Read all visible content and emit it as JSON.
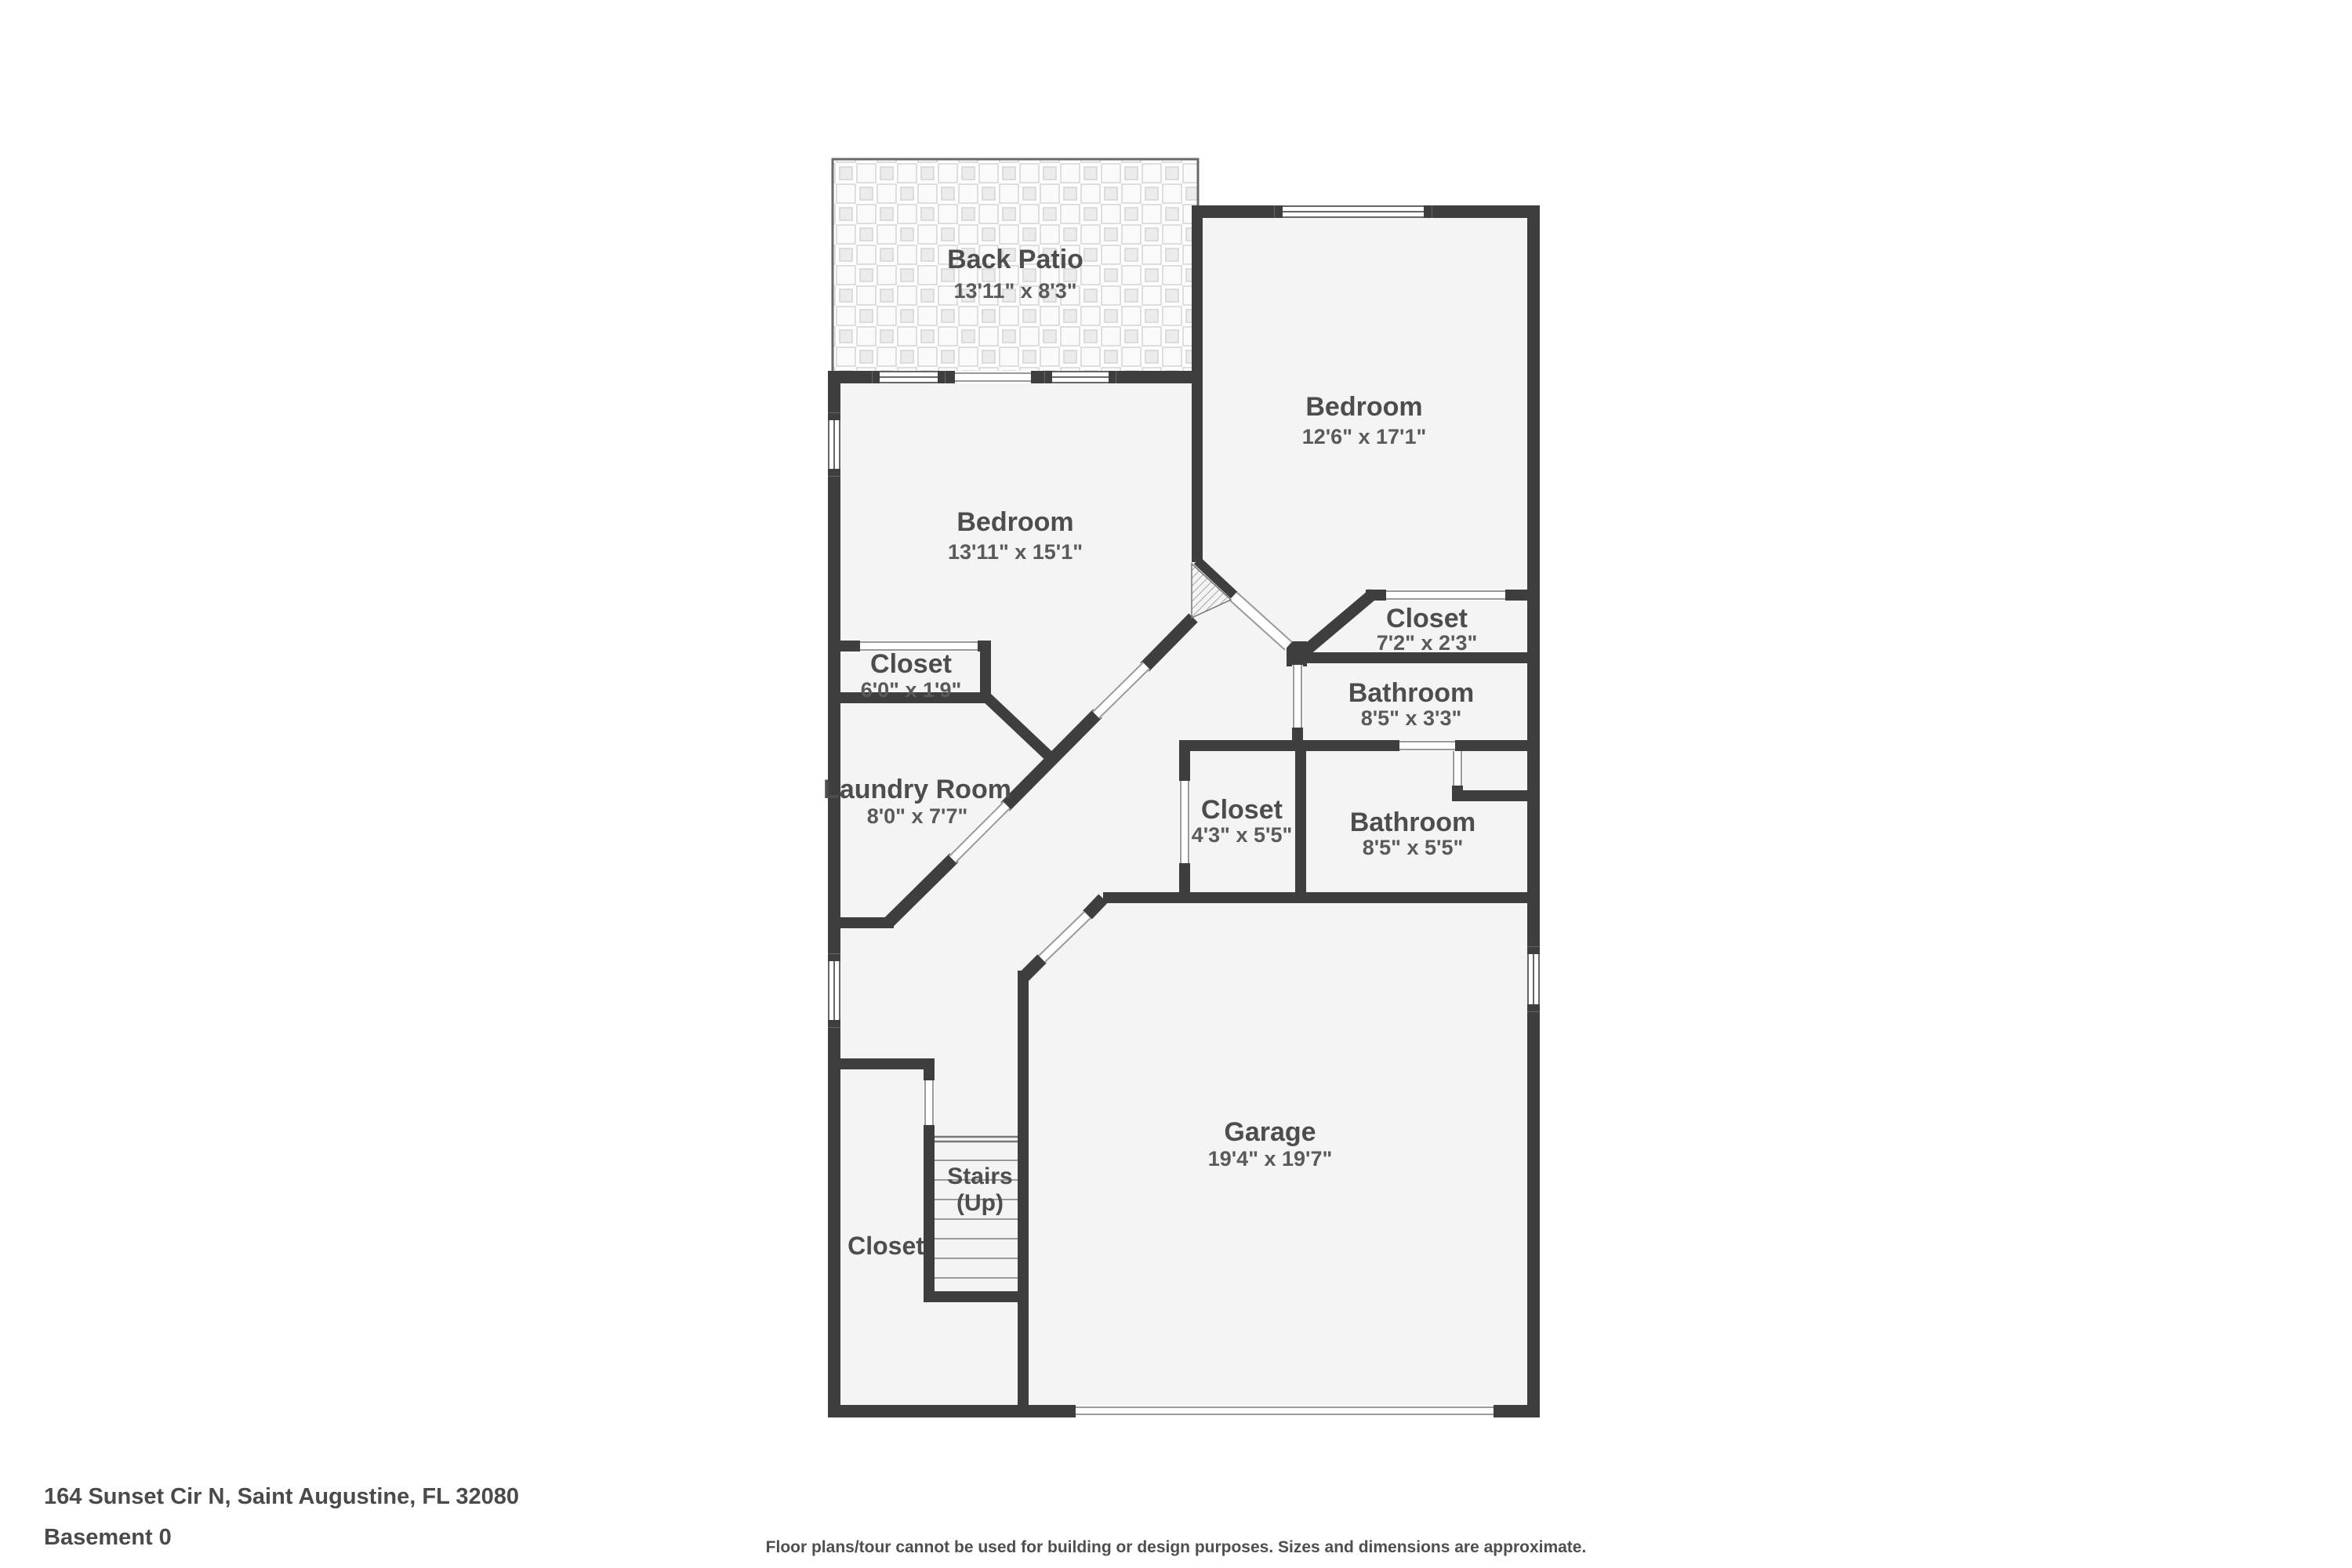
{
  "rooms": {
    "back_patio": {
      "name": "Back Patio",
      "dims": "13'11\" x 8'3\""
    },
    "bedroom_right": {
      "name": "Bedroom",
      "dims": "12'6\" x 17'1\""
    },
    "bedroom_left": {
      "name": "Bedroom",
      "dims": "13'11\" x 15'1\""
    },
    "closet_bedroom_left": {
      "name": "Closet",
      "dims": "6'0\" x 1'9\""
    },
    "closet_bedroom_right": {
      "name": "Closet",
      "dims": "7'2\" x 2'3\""
    },
    "bathroom_small": {
      "name": "Bathroom",
      "dims": "8'5\" x 3'3\""
    },
    "laundry": {
      "name": "Laundry Room",
      "dims": "8'0\" x 7'7\""
    },
    "closet_hall": {
      "name": "Closet",
      "dims": "4'3\" x 5'5\""
    },
    "bathroom_large": {
      "name": "Bathroom",
      "dims": "8'5\" x 5'5\""
    },
    "garage": {
      "name": "Garage",
      "dims": "19'4\" x 19'7\""
    },
    "stairs": {
      "name": "Stairs",
      "note": "(Up)"
    },
    "closet_lower": {
      "name": "Closet"
    }
  },
  "footer": {
    "address": "164 Sunset Cir N, Saint Augustine, FL 32080",
    "floor_label": "Basement 0",
    "disclaimer": "Floor plans/tour cannot be used for building or design purposes. Sizes and dimensions are approximate."
  },
  "colors": {
    "wall": "#3e3e3e",
    "floor": "#f4f4f4",
    "text": "#4d4d4d"
  }
}
